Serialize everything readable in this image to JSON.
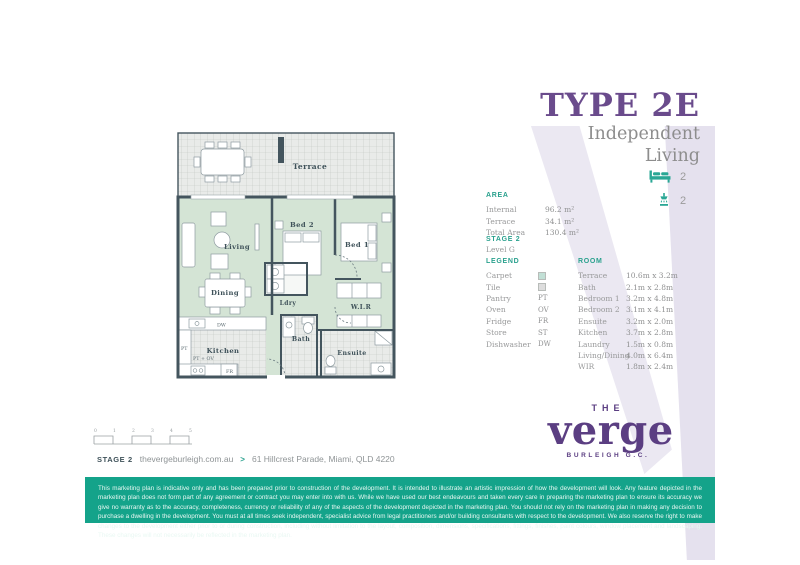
{
  "header": {
    "title": "TYPE 2E",
    "subtitle_line1": "Independent",
    "subtitle_line2": "Living"
  },
  "stats": {
    "bed_count": "2",
    "bath_count": "2"
  },
  "area": {
    "heading": "AREA",
    "rows": [
      {
        "label": "Internal",
        "value": "96.2 m²"
      },
      {
        "label": "Terrace",
        "value": "34.1 m²"
      },
      {
        "label": "Total Area",
        "value": "130.4 m²"
      }
    ]
  },
  "stage": {
    "heading": "STAGE 2",
    "level": "Level G"
  },
  "legend": {
    "heading": "LEGEND",
    "swatch_items": [
      {
        "label": "Carpet"
      },
      {
        "label": "Tile"
      }
    ],
    "code_items": [
      {
        "label": "Pantry",
        "code": "PT"
      },
      {
        "label": "Oven",
        "code": "OV"
      },
      {
        "label": "Fridge",
        "code": "FR"
      },
      {
        "label": "Store",
        "code": "ST"
      },
      {
        "label": "Dishwasher",
        "code": "DW"
      }
    ]
  },
  "rooms": {
    "heading": "ROOM",
    "items": [
      {
        "name": "Terrace",
        "dims": "10.6m x 3.2m"
      },
      {
        "name": "Bath",
        "dims": "2.1m x 2.8m"
      },
      {
        "name": "Bedroom 1",
        "dims": "3.2m x 4.8m"
      },
      {
        "name": "Bedroom 2",
        "dims": "3.1m x 4.1m"
      },
      {
        "name": "Ensuite",
        "dims": "3.2m x 2.0m"
      },
      {
        "name": "Kitchen",
        "dims": "3.7m x 2.8m"
      },
      {
        "name": "Laundry",
        "dims": "1.5m x 0.8m"
      },
      {
        "name": "Living/Dining",
        "dims": "4.0m x 6.4m"
      },
      {
        "name": "WIR",
        "dims": "1.8m x 2.4m"
      }
    ]
  },
  "floorplan": {
    "labels": {
      "terrace": "Terrace",
      "living": "Living",
      "dining": "Dining",
      "bed2": "Bed 2",
      "bed1": "Bed 1",
      "ldry": "Ldry",
      "wir": "W.I.R",
      "kitchen": "Kitchen",
      "bath": "Bath",
      "ensuite": "Ensuite",
      "dw": "DW",
      "pt": "PT",
      "pt_ov": "PT + OV",
      "fr": "FR"
    }
  },
  "logo": {
    "the": "THE",
    "name": "verge",
    "tagline": "BURLEIGH G.C."
  },
  "footer": {
    "stage": "STAGE 2",
    "website": "thevergeburleigh.com.au",
    "arrow": ">",
    "address": "61 Hillcrest Parade, Miami, QLD 4220"
  },
  "scalebar": {
    "ticks": [
      "0",
      "1",
      "2",
      "3",
      "4",
      "5"
    ]
  },
  "disclaimer": {
    "text": "This marketing plan is indicative only and has been prepared prior to construction of the development. It is intended to illustrate an artistic impression of how the development will look. Any feature depicted in the marketing plan does not form part of any agreement or contract you may enter into with us. While we have used our best endeavours and taken every care in preparing the marketing plan to ensure its accuracy we give no warranty as to the accuracy, completeness, currency or reliability of any of the aspects of the development depicted in the marketing plan. You should not rely on the marketing plan in making any decision to purchase a dwelling in the development. You must at all times seek independent, specialist advice from legal practitioners and/or building consultants with respect to the development. We also reserve the right to make changes to the development either prior to or during construction, including without limitation to the layout, composition, dimensions, specifications, fittings, finishes, paint colours, window placement and landscaping. These changes will not necessarily be reflected in the marketing plan."
  },
  "colors": {
    "purple": "#6a4b8c",
    "logo_purple": "#5b3e82",
    "teal_accent": "#2aa18e",
    "green_bar": "#14a38a",
    "carpet": "#d4e4d5",
    "wall": "#44555e",
    "text_gray": "#98999a"
  }
}
